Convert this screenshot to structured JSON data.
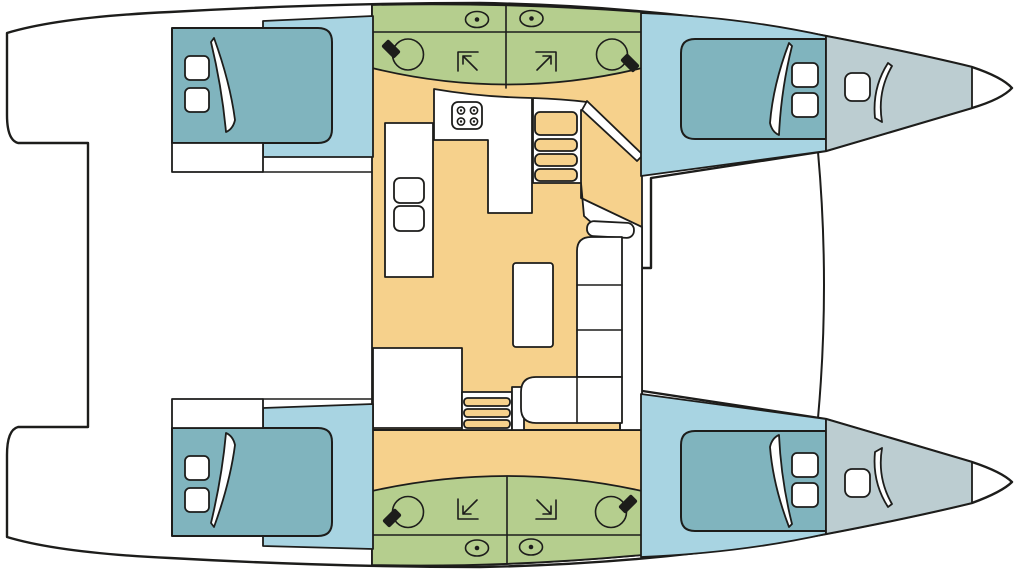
{
  "diagram": {
    "kind": "catamaran-deck-plan",
    "orientation": {
      "bow": "right",
      "stern": "left"
    }
  },
  "palette": {
    "background": "#ffffff",
    "line": "#1d1d1b",
    "salon": "#f6d18c",
    "heads": "#b5ce8e",
    "cabin": "#a8d4e2",
    "bed": "#80b4be",
    "locker": "#bccdd1",
    "fixture": "#1d1d1b"
  },
  "icons": {
    "sink": "circle-with-black-faucet-wedge",
    "shower": "corner-bracket-with-diagonal-arrow",
    "stove": "square-hob-with-4-burners",
    "deck_vent": "oval-with-center-dot",
    "stairs": "parallel-tread-bands",
    "bed_pillow": "rounded-square",
    "duvet_fold": "curved-white-sliver",
    "bow_hatch": "rounded-square"
  },
  "features": {
    "double_berths": 4,
    "heads_compartments": 4,
    "sinks": 4,
    "showers": 4,
    "deck_vents": 4,
    "bow_lockers": 2,
    "stove_burners": 4,
    "companionway_stairs": 2,
    "saloon_table": 1,
    "l_shaped_settee": 1,
    "galley_sinks": 2,
    "nav_desk": 1
  }
}
